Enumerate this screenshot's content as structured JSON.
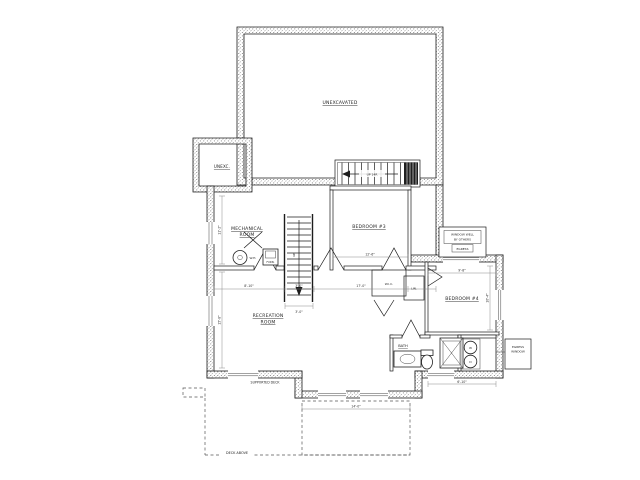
{
  "title": "Basement Floor Plan",
  "colors": {
    "ink": "#1c1c1c",
    "paper": "#ffffff",
    "dim_lines": "#808080"
  },
  "rooms": {
    "unexcavated": "UNEXCAVATED",
    "unexc_small": "UNEXC.",
    "mechanical_1": "MECHANICAL",
    "mechanical_2": "ROOM",
    "bedroom3": "BEDROOM #3",
    "bedroom4": "BEDROOM #4",
    "recreation_1": "RECREATION",
    "recreation_2": "ROOM",
    "bath": "BATH",
    "wic": "W.I.C.",
    "linen": "LIN."
  },
  "stairs": {
    "upper_label": "UP 14R",
    "lower_label": "UP"
  },
  "fixtures": {
    "water_heater": "W.H.",
    "furnace": "FURN.",
    "washer": "W",
    "dryer": "D"
  },
  "notes": {
    "window_well_1": "WINDOW WELL",
    "window_well_2": "BY OTHERS",
    "window_well_3": "EGRESS",
    "deck": "DECK ABOVE",
    "supported_deck": "SUPPORTED DECK",
    "egress_callout_1": "EGRESS",
    "egress_callout_2": "WINDOW"
  },
  "dimensions": {
    "rec_w1": "8'-10\"",
    "rec_w2": "3'-0\"",
    "rec_w3": "17'-0\"",
    "bed3_w": "12'-6\"",
    "bed4_w": "9'-8\"",
    "bed4_h": "10'-4\"",
    "mech_h": "11'-2\"",
    "rec_h": "15'-8\"",
    "stair_w": "3'-0\"",
    "bath_w": "6'-10\"",
    "deck_w": "14'-0\""
  }
}
